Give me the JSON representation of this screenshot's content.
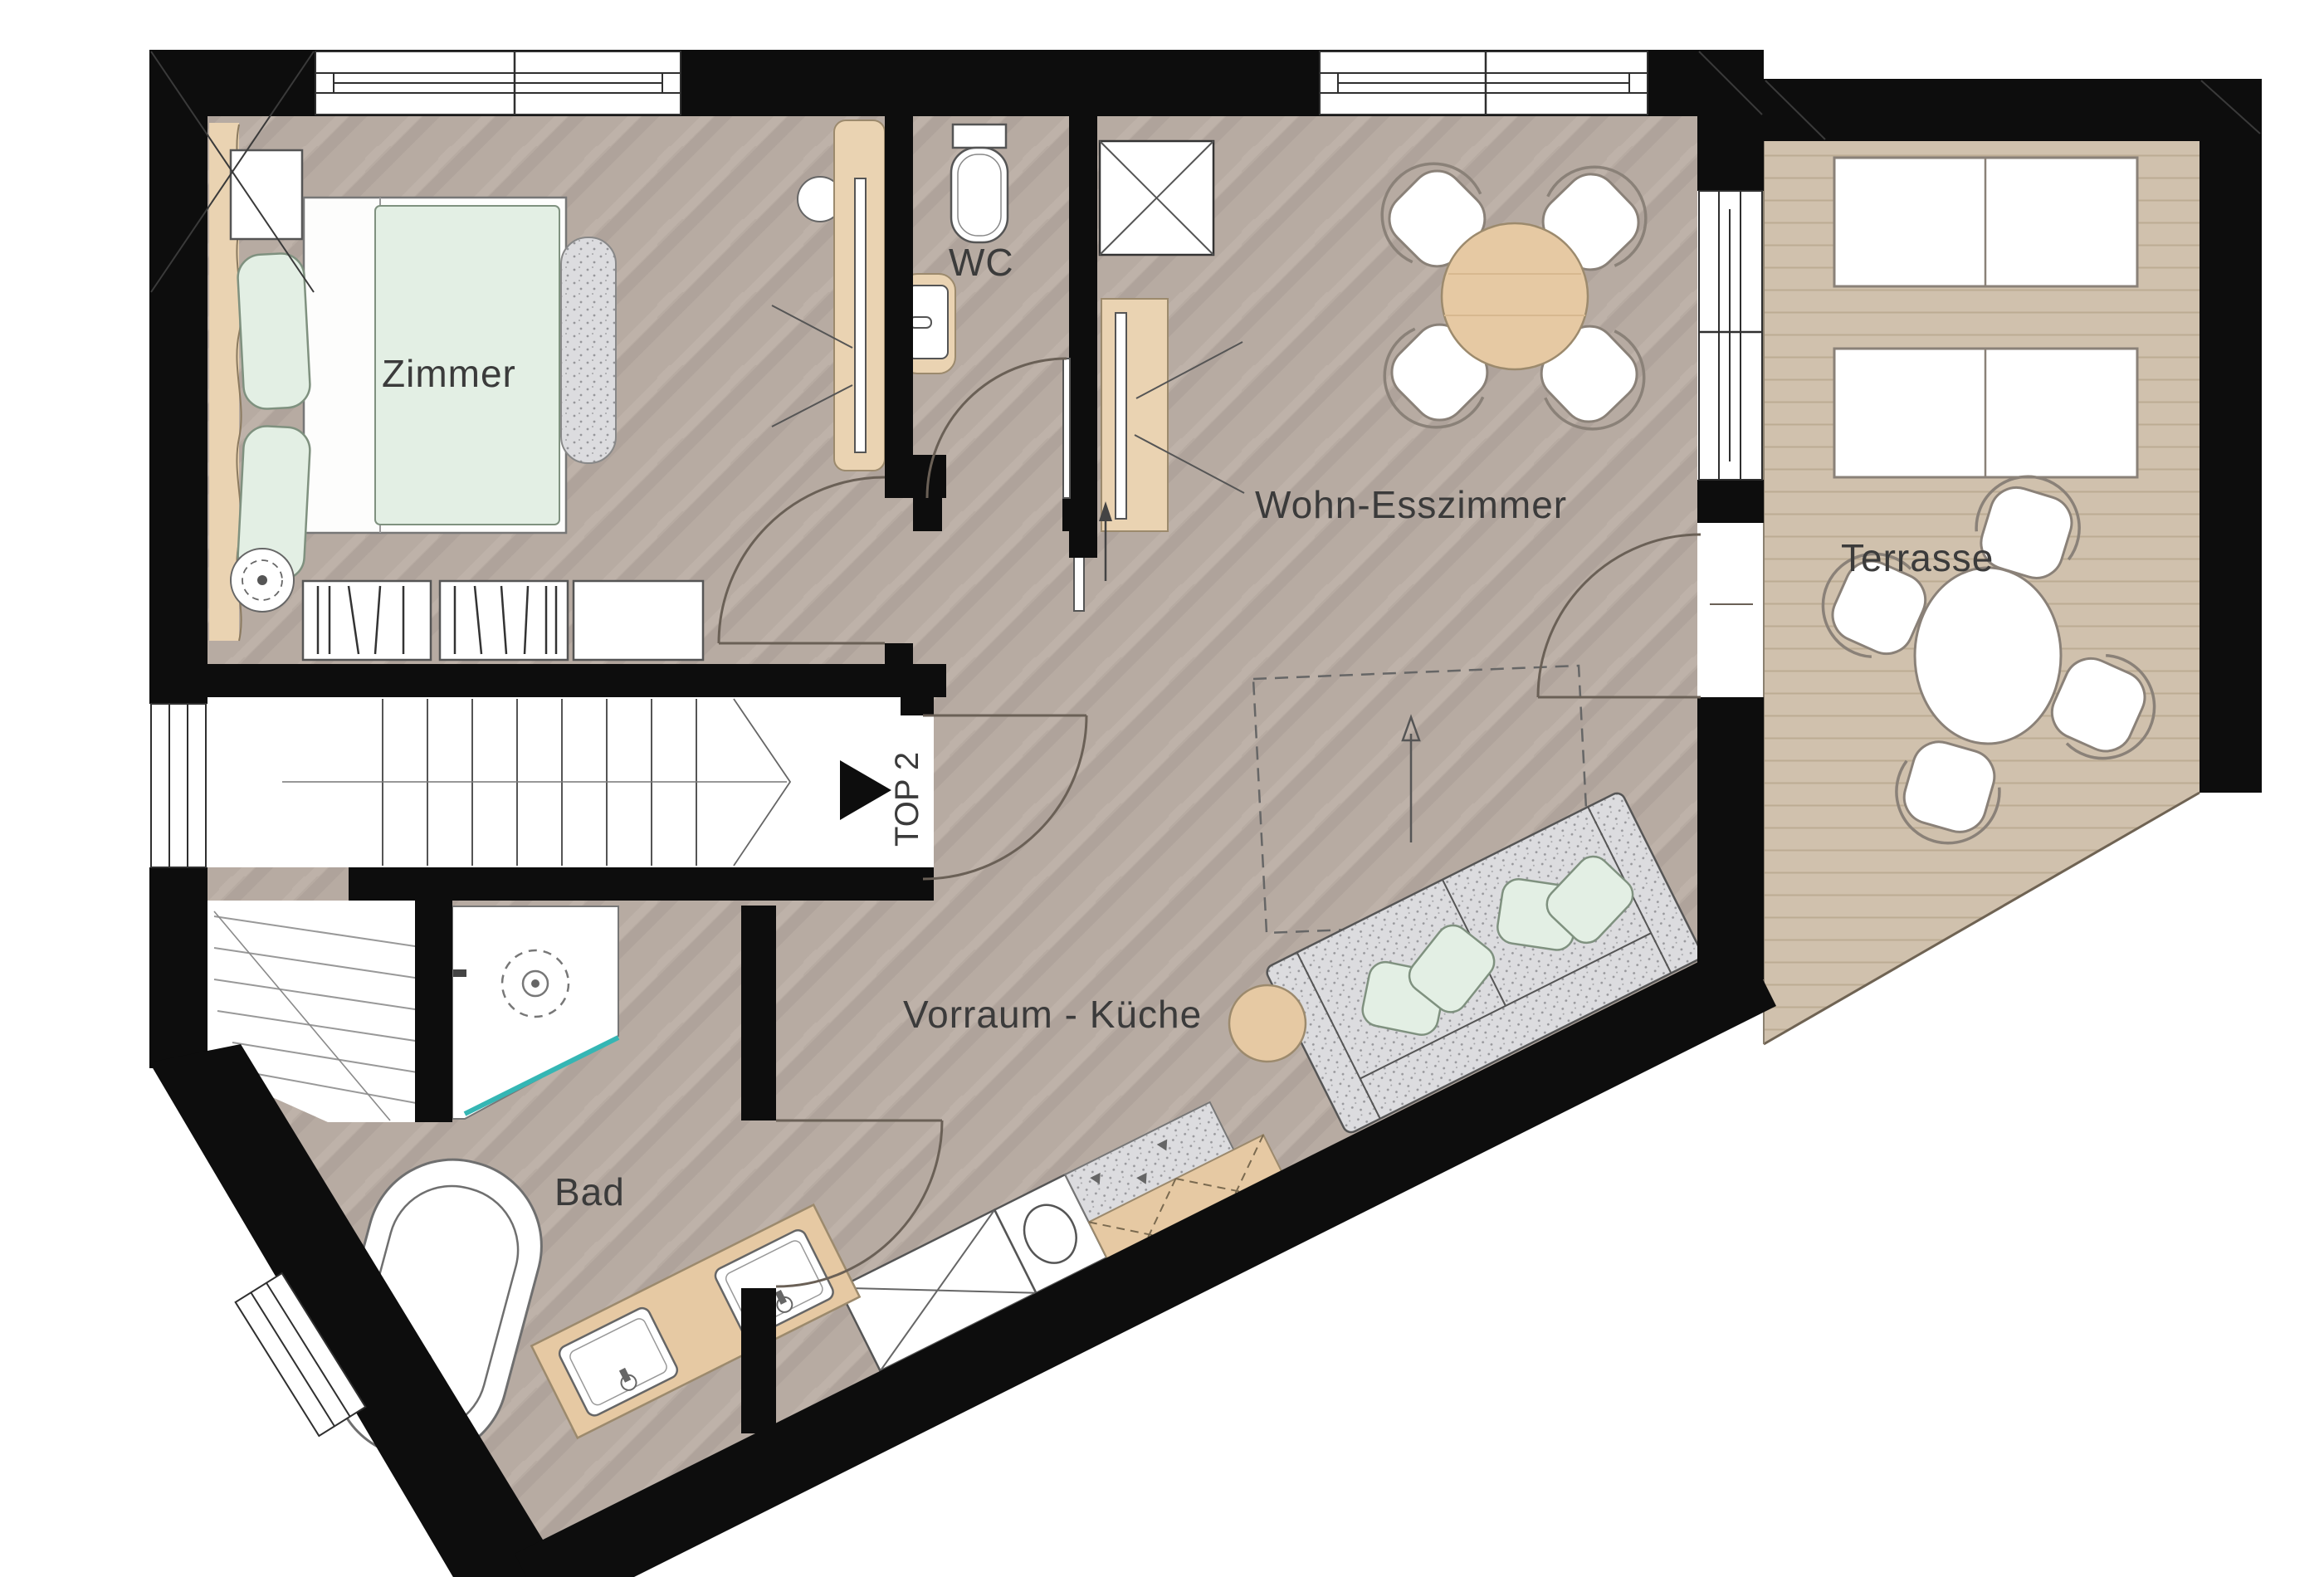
{
  "plan": {
    "type": "apartment-floor-plan",
    "unit_marker": {
      "label": "TOP 2"
    },
    "rooms": {
      "zimmer": {
        "label": "Zimmer"
      },
      "wc": {
        "label": "WC"
      },
      "wohn_esszimmer": {
        "label": "Wohn-Esszimmer"
      },
      "terrasse": {
        "label": "Terrasse"
      },
      "vorraum_kueche": {
        "label": "Vorraum - Küche"
      },
      "bad": {
        "label": "Bad"
      }
    },
    "colors": {
      "wall": "#0d0d0d",
      "parquet": "#b7aba2",
      "deck": "#d0c1ad",
      "wood_furniture": "#e6c9a3",
      "textile_mint": "#e3efe4",
      "textile_gray": "#dcdcdf",
      "shower_glass": "#35b6b4",
      "label_text": "#3b3b3b"
    }
  }
}
